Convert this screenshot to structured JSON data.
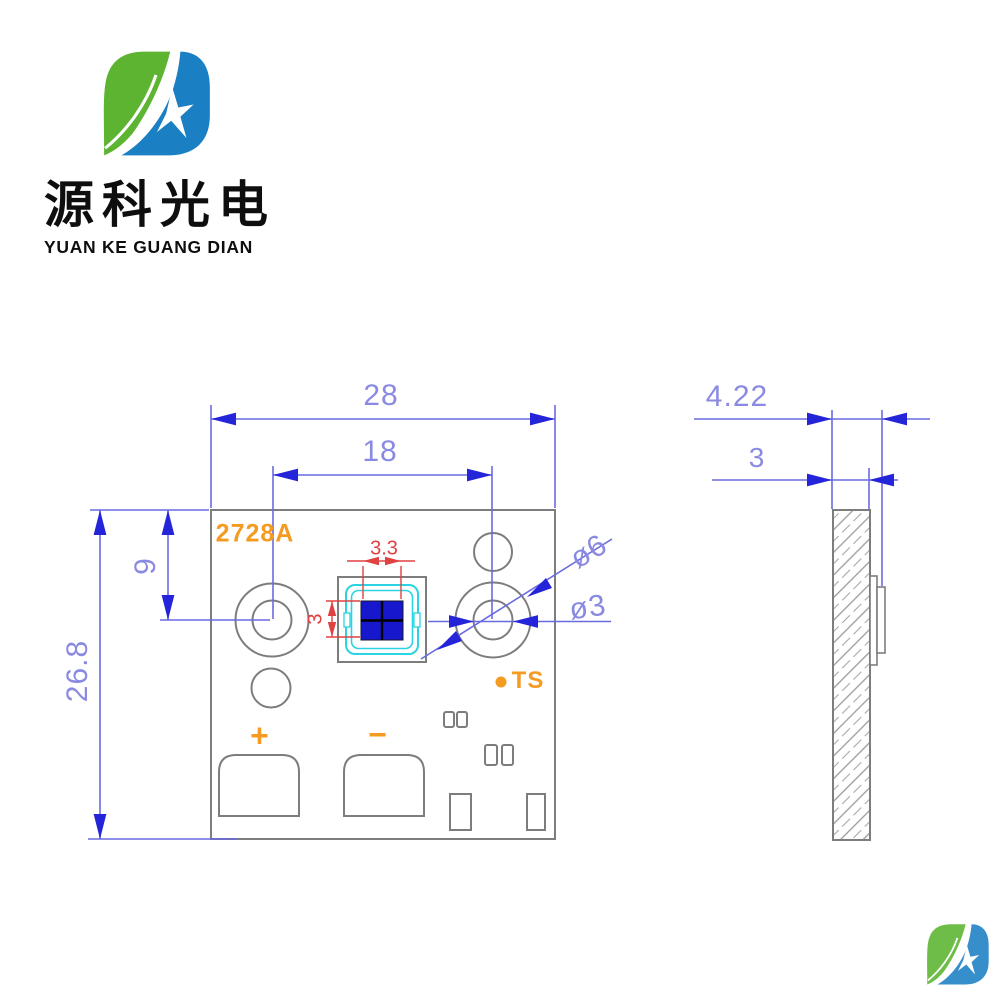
{
  "header": {
    "company_cn": "源科光电",
    "company_en": "YUAN KE GUANG DIAN"
  },
  "front_view": {
    "part_number": "2728A",
    "positive_label": "+",
    "negative_label": "−",
    "thermal_pad_label": "TS",
    "dims": {
      "board_width": "28",
      "hole_spacing": "18",
      "board_height": "26.8",
      "hole_top_offset": "9",
      "hole_outer_dia": "ø6",
      "hole_inner_dia": "ø3",
      "die_width": "3.3",
      "die_height": "3"
    }
  },
  "side_view": {
    "dims": {
      "total_thickness": "4.22",
      "board_thickness": "3"
    }
  },
  "colors": {
    "dimension_line_blue": "#6a6ae0",
    "dimension_arrow_blue": "#2424d8",
    "dimension_text_blue": "#8a8ae2",
    "dimension_red": "#e04141",
    "annotation_orange": "#f59b22",
    "outline_gray": "#7d7d7d",
    "led_frame_cyan": "#2ad4e0",
    "die_blue": "#1717cd",
    "logo_green": "#5cb431",
    "logo_blue": "#1b7fc4"
  }
}
